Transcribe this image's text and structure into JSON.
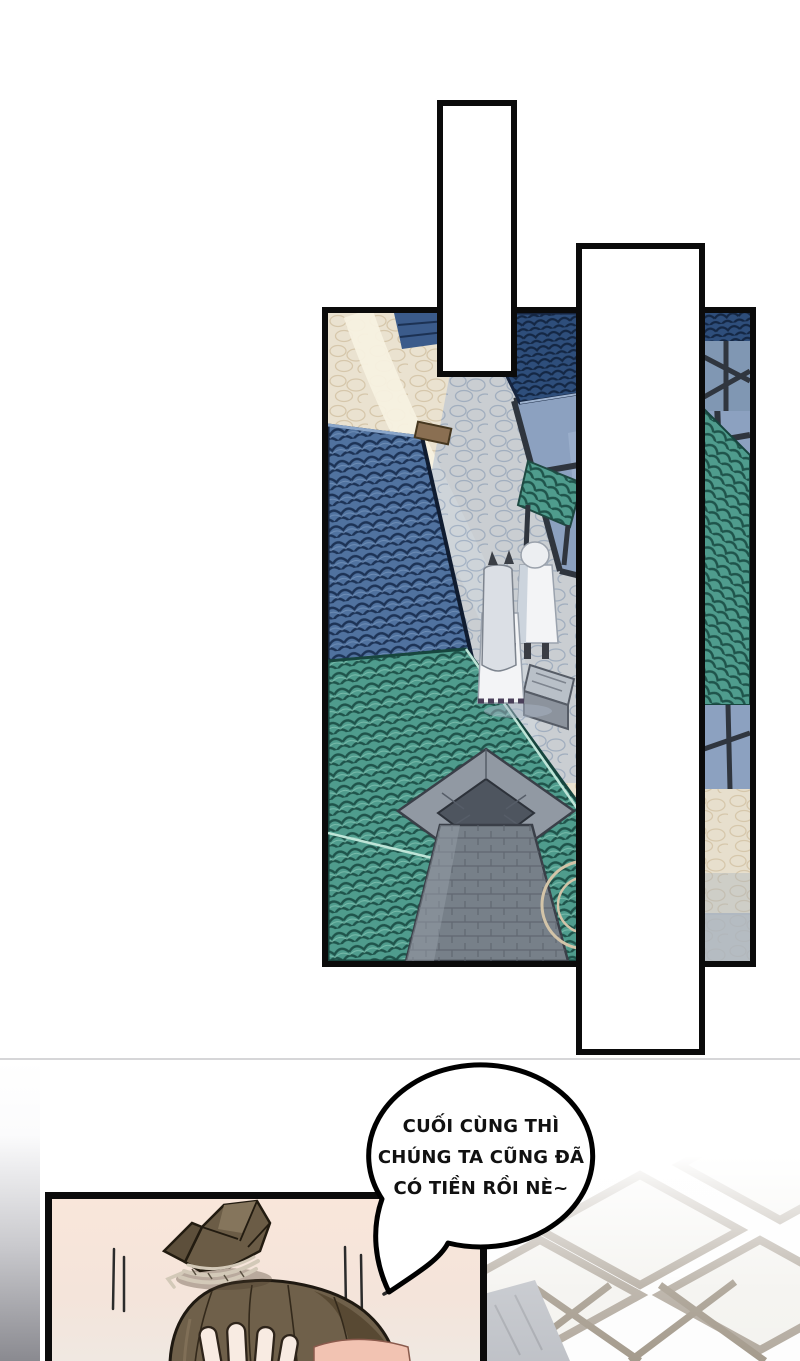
{
  "page": {
    "kind": "webtoon-comic-page",
    "background": "#ffffff"
  },
  "speech_bubble": {
    "lines": [
      "CUỐI CÙNG THÌ",
      "CHÚNG TA CŨNG ĐÃ",
      "CÓ TIỀN RỒI NÈ~"
    ],
    "fill": "#ffffff",
    "outline": "#000000",
    "text_color": "#111111"
  },
  "panels": {
    "village_panel": {
      "name": "village-aerial-panel",
      "border_color": "#0b0b0b",
      "elements": [
        "cobblestone-street",
        "winding-path",
        "steel-blue-tile-roof",
        "teal-tile-roofs",
        "dark-blue-roof",
        "timber-frame-building",
        "market-stall-awning",
        "stone-chimney",
        "two-walking-figures",
        "stone-bench",
        "circular-paving"
      ]
    },
    "empty_balloon_1": {
      "name": "blank-vertical-balloon",
      "fill": "#ffffff",
      "border_color": "#0b0b0b"
    },
    "empty_balloon_2": {
      "name": "blank-vertical-balloon",
      "fill": "#ffffff",
      "border_color": "#0b0b0b"
    },
    "bottom_panel": {
      "name": "head-grab-panel",
      "border_color": "#0b0b0b",
      "background": "#f7e5da",
      "elements": [
        "tied-hair-bundle",
        "cord-wrap",
        "brown-hair-dome",
        "gripping-fingers",
        "speed-lines",
        "emphasis-mark"
      ]
    }
  },
  "background_art": {
    "left_gradient_strip": {
      "top": "#ffffff",
      "bottom": "#8a8a90"
    },
    "faded_rooftop_blocks": {
      "beam_color": "#a79d90",
      "block_color": "#f3f1ed",
      "tarp_color": "#b6b9bf"
    },
    "divider_line_color": "#d6d6d8"
  },
  "palette": {
    "cobblestone": "#eae2d0",
    "path_highlight": "#f7f1e0",
    "shadow_cobble": "#b4c2d4",
    "blue_roof": "#50729f",
    "teal_roof": "#4f9c8d",
    "dark_blue_roof": "#2e4e7b",
    "timber": "#2f353e",
    "wall": "#8ca1c0",
    "chimney_stone": "#9199a3",
    "hair_brown": "#6f604a",
    "skin": "#f8ebe2",
    "pink_skin": "#f2c3b2"
  }
}
